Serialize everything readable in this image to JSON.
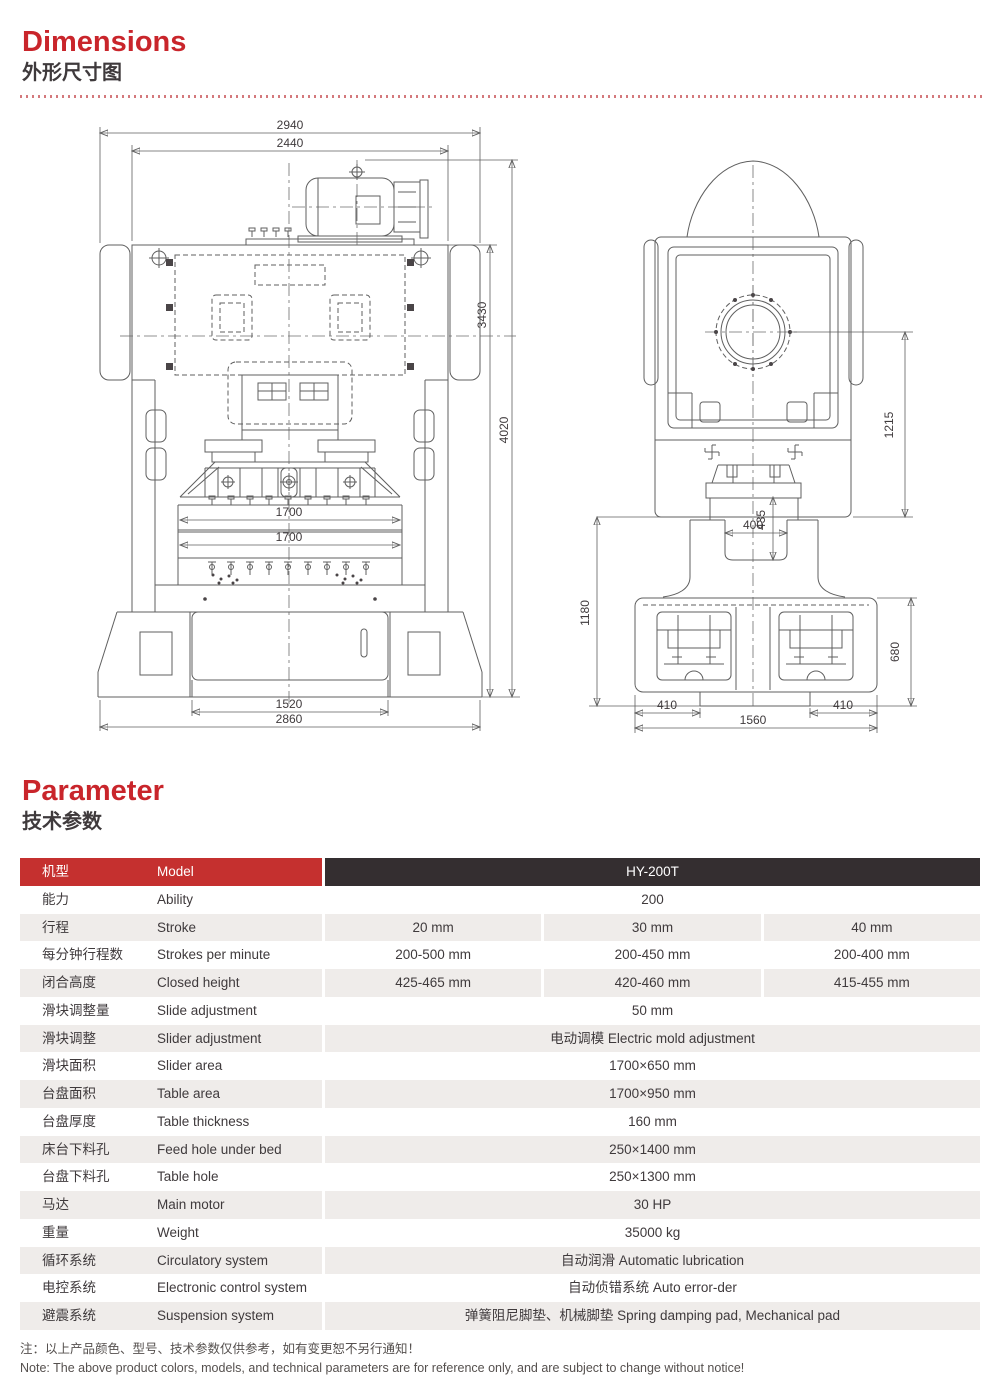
{
  "page": {
    "dimensions_title": "Dimensions",
    "dimensions_subtitle": "外形尺寸图",
    "parameter_title": "Parameter",
    "parameter_subtitle": "技术参数"
  },
  "drawing": {
    "front_view": {
      "dims": {
        "overall_width": "2940",
        "inner_width": "2440",
        "frame_height": "3430",
        "overall_height": "4020",
        "slide_width": "1700",
        "bolster_width": "1700",
        "base_center_width": "1520",
        "base_width": "2860"
      }
    },
    "side_view": {
      "dims": {
        "crank_center_height": "1215",
        "throat_width": "400",
        "throat_depth": "435",
        "base_section_height": "1180",
        "foot_height": "680",
        "foot_offset_left": "410",
        "foot_offset_right": "410",
        "base_depth": "1560"
      }
    }
  },
  "table": {
    "header": {
      "cn": "机型",
      "en": "Model",
      "value": "HY-200T"
    },
    "rows": [
      {
        "cn": "能力",
        "en": "Ability",
        "values": [
          "200"
        ]
      },
      {
        "cn": "行程",
        "en": "Stroke",
        "values": [
          "20 mm",
          "30 mm",
          "40 mm"
        ]
      },
      {
        "cn": "每分钟行程数",
        "en": "Strokes per minute",
        "values": [
          "200-500 mm",
          "200-450 mm",
          "200-400 mm"
        ]
      },
      {
        "cn": "闭合高度",
        "en": "Closed height",
        "values": [
          "425-465 mm",
          "420-460 mm",
          "415-455 mm"
        ]
      },
      {
        "cn": "滑块调整量",
        "en": "Slide adjustment",
        "values": [
          "50 mm"
        ]
      },
      {
        "cn": "滑块调整",
        "en": "Slider adjustment",
        "values": [
          "电动调模 Electric mold adjustment"
        ]
      },
      {
        "cn": "滑块面积",
        "en": "Slider area",
        "values": [
          "1700×650 mm"
        ]
      },
      {
        "cn": "台盘面积",
        "en": "Table area",
        "values": [
          "1700×950 mm"
        ]
      },
      {
        "cn": "台盘厚度",
        "en": "Table thickness",
        "values": [
          "160 mm"
        ]
      },
      {
        "cn": "床台下料孔",
        "en": "Feed hole under bed",
        "values": [
          "250×1400 mm"
        ]
      },
      {
        "cn": "台盘下料孔",
        "en": "Table hole",
        "values": [
          "250×1300 mm"
        ]
      },
      {
        "cn": "马达",
        "en": "Main motor",
        "values": [
          "30 HP"
        ]
      },
      {
        "cn": "重量",
        "en": "Weight",
        "values": [
          "35000 kg"
        ]
      },
      {
        "cn": "循环系统",
        "en": "Circulatory system",
        "values": [
          "自动润滑 Automatic lubrication"
        ]
      },
      {
        "cn": "电控系统",
        "en": "Electronic control system",
        "values": [
          "自动侦错系统 Auto error-der"
        ]
      },
      {
        "cn": "避震系统",
        "en": "Suspension system",
        "values": [
          "弹簧阻尼脚垫、机械脚垫 Spring damping pad, Mechanical pad"
        ]
      }
    ]
  },
  "note": {
    "cn": "注：以上产品颜色、型号、技术参数仅供参考，如有变更恕不另行通知！",
    "en": "Note: The above product colors, models, and technical parameters are for reference only, and are subject to change without notice!"
  },
  "colors": {
    "accent_red": "#c5302f",
    "header_dark": "#342e30",
    "row_alt_gray": "#efecea",
    "title_red": "#c9252b"
  }
}
